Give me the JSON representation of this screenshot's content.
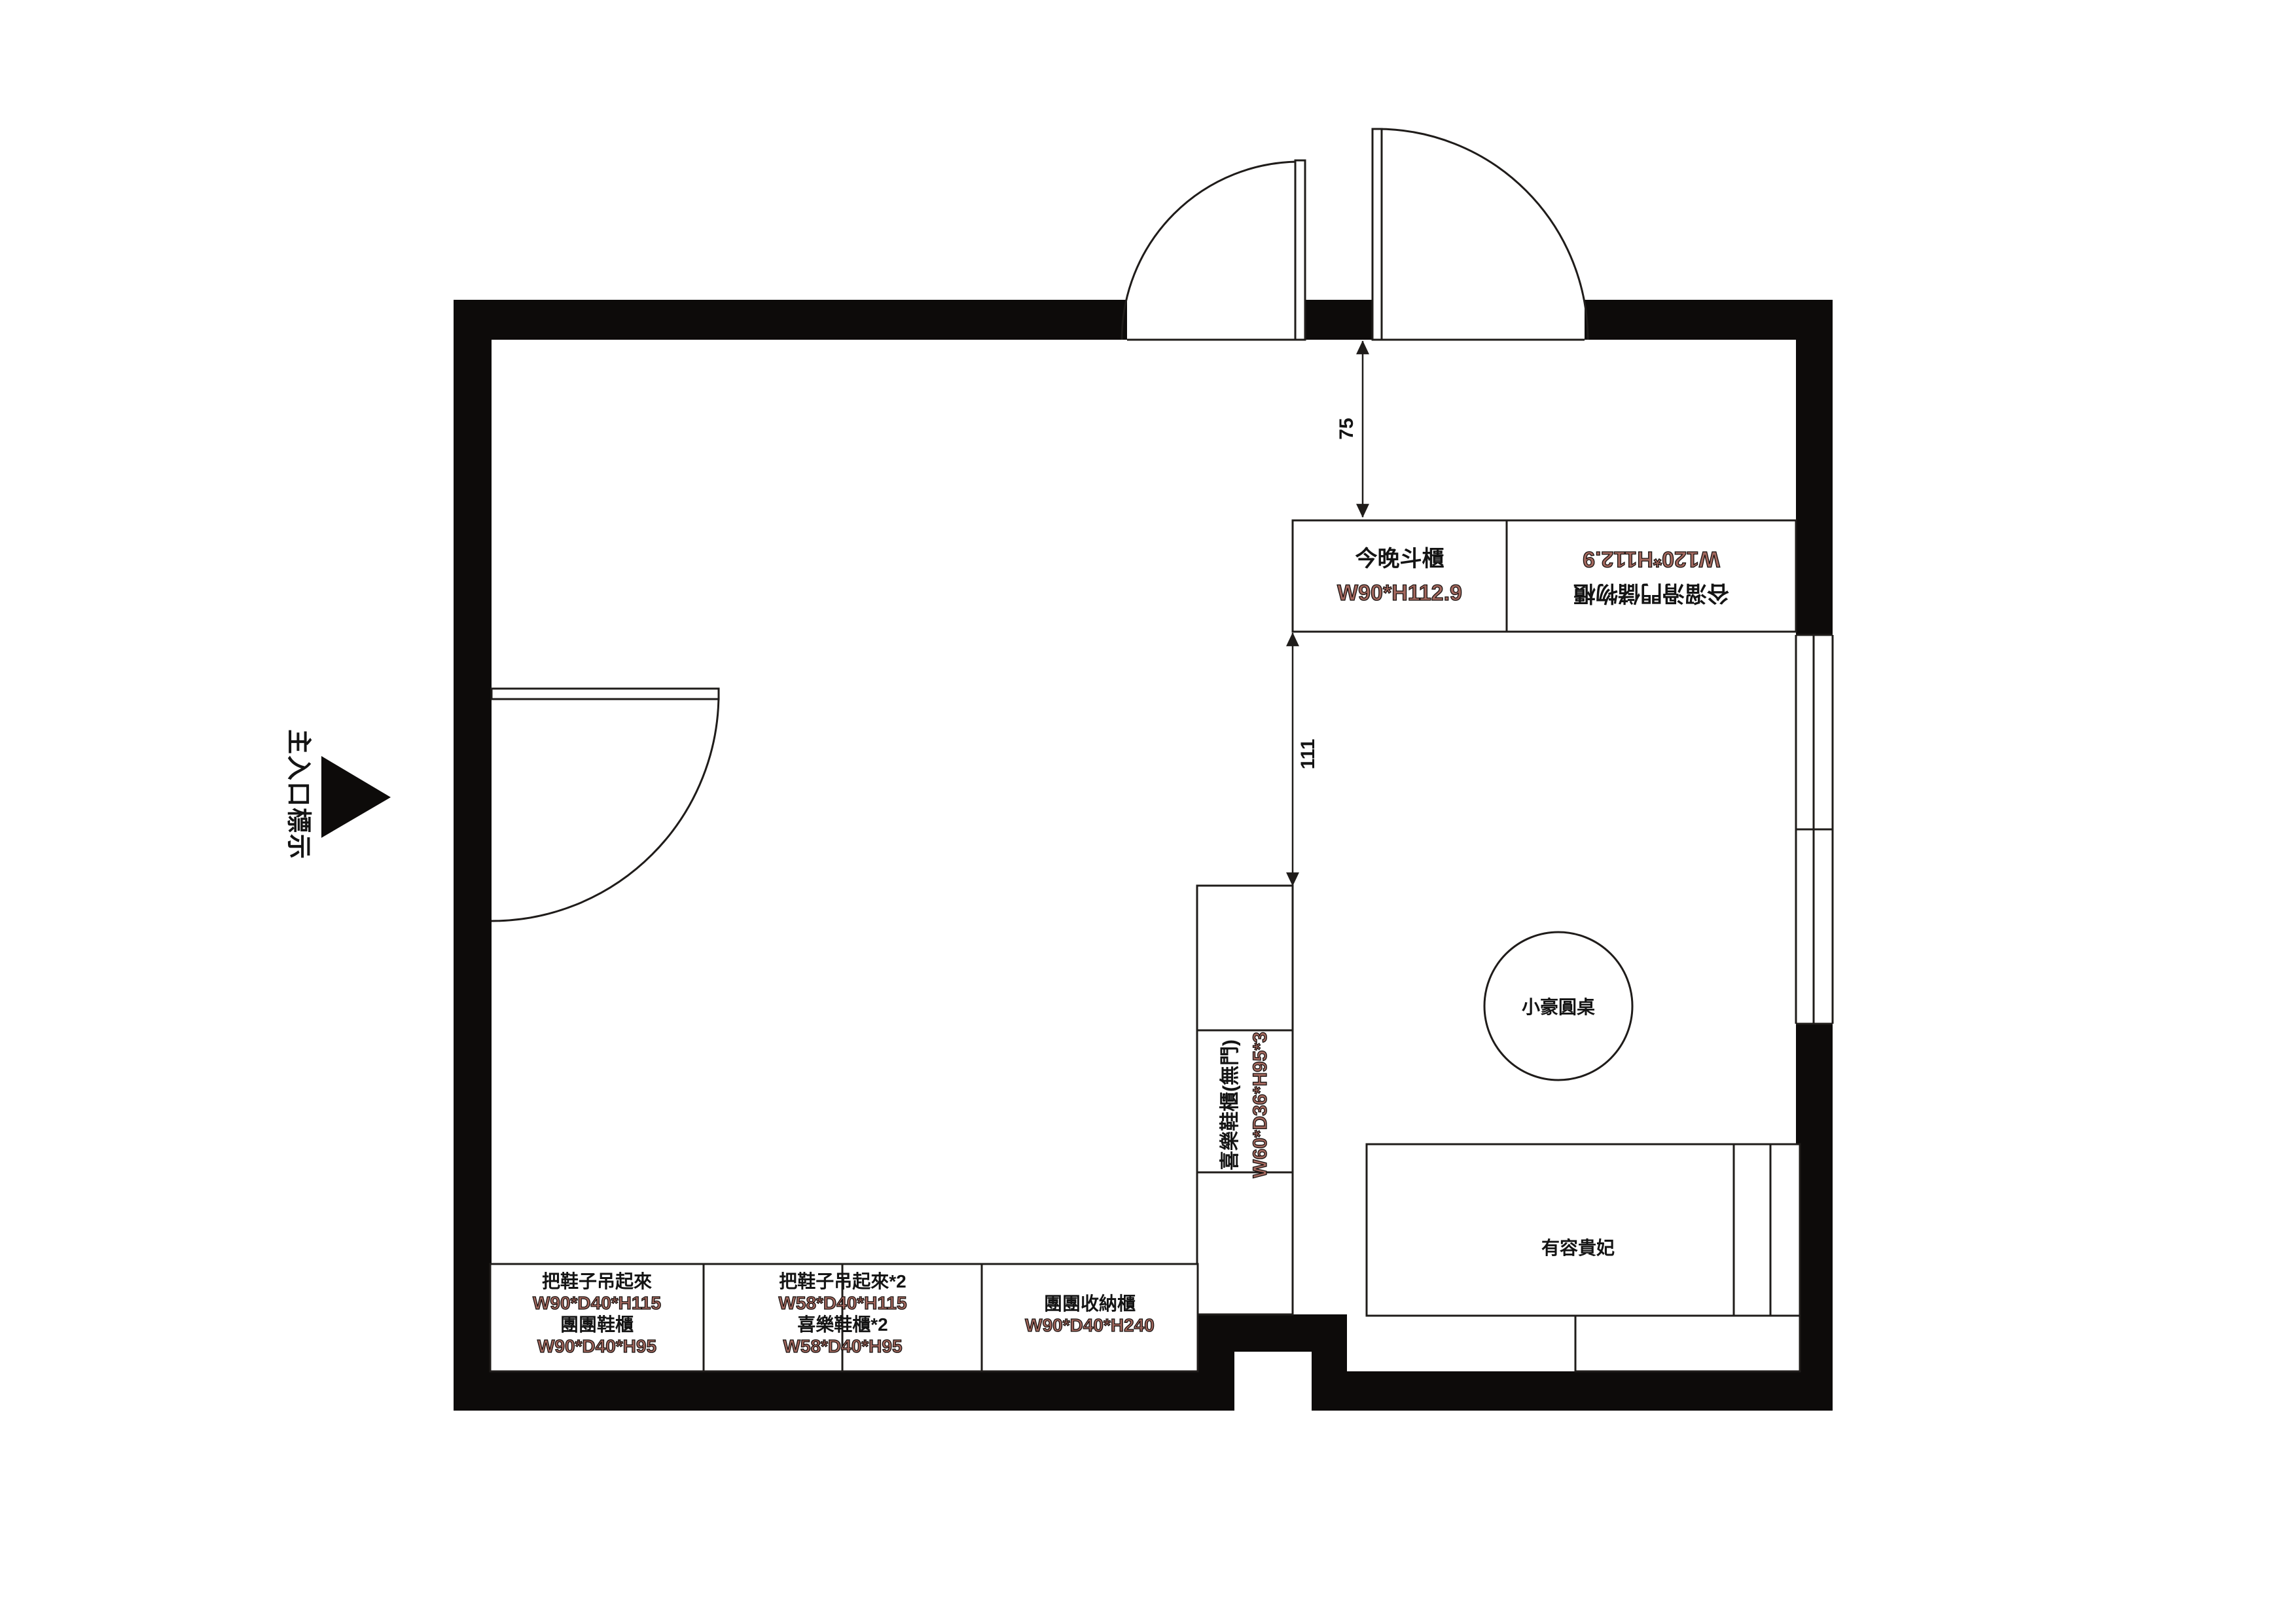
{
  "colors": {
    "wall": "#0d0b0a",
    "line": "#1f1c1a",
    "dim_text": "#a3685e",
    "label_text": "#141414"
  },
  "entrance": {
    "label": "主入口標示"
  },
  "dims": {
    "top_gap": "75",
    "middle_gap": "111"
  },
  "top_cabinets": {
    "left": {
      "name": "今晚斗櫃",
      "dims": "W90*H112.9"
    },
    "right": {
      "name": "谷溜滑門儲物櫃",
      "dims": "W120*H112.9"
    }
  },
  "side_cabinet": {
    "name": "喜樂鞋櫃(無門)",
    "dims": "W60*D36*H95*3"
  },
  "furniture": {
    "round_table": "小豪圓桌",
    "chaise": "有容貴妃"
  },
  "bottom_cabinets": {
    "cell1": {
      "l1": "把鞋子吊起來",
      "l2": "W90*D40*H115",
      "l3": "團團鞋櫃",
      "l4": "W90*D40*H95"
    },
    "cell2": {
      "l1": "把鞋子吊起來*2",
      "l2": "W58*D40*H115",
      "l3": "喜樂鞋櫃*2",
      "l4": "W58*D40*H95"
    },
    "cell3": {
      "l1": "團團收納櫃",
      "l2": "W90*D40*H240"
    }
  }
}
